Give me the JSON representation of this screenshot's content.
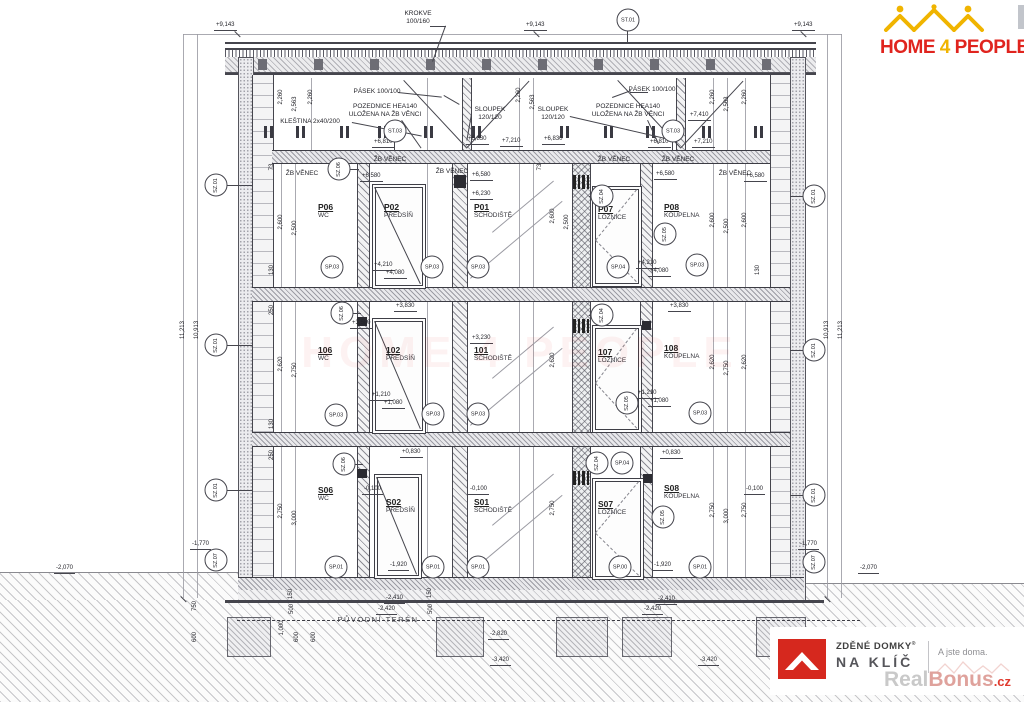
{
  "branding": {
    "header": {
      "word1": "HOME",
      "word2": "4",
      "word3": "PEOPLE"
    },
    "watermark_text": "HOME 4 PEOPLE",
    "footer": {
      "brand_bold": "ZDĚNÉ DOMKY",
      "reg": "®",
      "brand_sub": "NA KLÍČ",
      "tagline": "A jste doma.",
      "wm1": "Real",
      "wm2": "Bonus",
      "wm3": ".cz"
    }
  },
  "colors": {
    "red": "#e0241e",
    "yellow": "#f0b400",
    "line": "#45454d"
  },
  "rooms": [
    {
      "num": "P06",
      "name": "WC",
      "x": 318,
      "y": 203
    },
    {
      "num": "P02",
      "name": "PŘEDSÍŇ",
      "x": 384,
      "y": 203
    },
    {
      "num": "P01",
      "name": "SCHODIŠTĚ",
      "x": 474,
      "y": 203
    },
    {
      "num": "P07",
      "name": "LOŽNICE",
      "x": 598,
      "y": 205
    },
    {
      "num": "P08",
      "name": "KOUPELNA",
      "x": 664,
      "y": 203
    },
    {
      "num": "106",
      "name": "WC",
      "x": 318,
      "y": 346
    },
    {
      "num": "102",
      "name": "PŘEDSÍŇ",
      "x": 386,
      "y": 346
    },
    {
      "num": "101",
      "name": "SCHODIŠTĚ",
      "x": 474,
      "y": 346
    },
    {
      "num": "107",
      "name": "LOŽNICE",
      "x": 598,
      "y": 348
    },
    {
      "num": "108",
      "name": "KOUPELNA",
      "x": 664,
      "y": 344
    },
    {
      "num": "S06",
      "name": "WC",
      "x": 318,
      "y": 486
    },
    {
      "num": "S02",
      "name": "PŘEDSÍŇ",
      "x": 386,
      "y": 498
    },
    {
      "num": "S01",
      "name": "SCHODIŠTĚ",
      "x": 474,
      "y": 498
    },
    {
      "num": "S07",
      "name": "LOŽNICE",
      "x": 598,
      "y": 500
    },
    {
      "num": "S08",
      "name": "KOUPELNA",
      "x": 664,
      "y": 484
    }
  ],
  "elevations": [
    {
      "t": "+9,143",
      "x": 214,
      "y": 22
    },
    {
      "t": "+9,143",
      "x": 524,
      "y": 22
    },
    {
      "t": "+9,143",
      "x": 792,
      "y": 22
    },
    {
      "t": "+7,410",
      "x": 688,
      "y": 112
    },
    {
      "t": "+6,810",
      "x": 372,
      "y": 139
    },
    {
      "t": "+6,830",
      "x": 466,
      "y": 136
    },
    {
      "t": "+7,210",
      "x": 500,
      "y": 138
    },
    {
      "t": "+6,830",
      "x": 542,
      "y": 136
    },
    {
      "t": "+6,810",
      "x": 648,
      "y": 139
    },
    {
      "t": "+7,210",
      "x": 692,
      "y": 139
    },
    {
      "t": "+6,580",
      "x": 360,
      "y": 173
    },
    {
      "t": "+6,580",
      "x": 470,
      "y": 172
    },
    {
      "t": "+6,580",
      "x": 654,
      "y": 171
    },
    {
      "t": "+6,580",
      "x": 744,
      "y": 173
    },
    {
      "t": "+6,230",
      "x": 470,
      "y": 191
    },
    {
      "t": "+4,210",
      "x": 372,
      "y": 262
    },
    {
      "t": "+4,080",
      "x": 384,
      "y": 270
    },
    {
      "t": "+4,210",
      "x": 636,
      "y": 260
    },
    {
      "t": "+4,080",
      "x": 648,
      "y": 268
    },
    {
      "t": "+3,830",
      "x": 394,
      "y": 303
    },
    {
      "t": "+3,830",
      "x": 668,
      "y": 303
    },
    {
      "t": "+3,580",
      "x": 350,
      "y": 320
    },
    {
      "t": "+3,230",
      "x": 470,
      "y": 335
    },
    {
      "t": "+1,210",
      "x": 370,
      "y": 392
    },
    {
      "t": "+1,080",
      "x": 382,
      "y": 400
    },
    {
      "t": "+1,210",
      "x": 636,
      "y": 390
    },
    {
      "t": "+1,080",
      "x": 648,
      "y": 398
    },
    {
      "t": "+0,830",
      "x": 400,
      "y": 449
    },
    {
      "t": "+0,830",
      "x": 660,
      "y": 450
    },
    {
      "t": "-0,100",
      "x": 362,
      "y": 486
    },
    {
      "t": "-0,100",
      "x": 468,
      "y": 486
    },
    {
      "t": "-0,100",
      "x": 744,
      "y": 486
    },
    {
      "t": "-1,920",
      "x": 388,
      "y": 562
    },
    {
      "t": "-1,920",
      "x": 652,
      "y": 562
    },
    {
      "t": "-1,770",
      "x": 190,
      "y": 541
    },
    {
      "t": "-1,770",
      "x": 798,
      "y": 541
    },
    {
      "t": "-2,070",
      "x": 54,
      "y": 565
    },
    {
      "t": "-2,070",
      "x": 858,
      "y": 565
    },
    {
      "t": "-2,410",
      "x": 384,
      "y": 595
    },
    {
      "t": "-2,420",
      "x": 376,
      "y": 606
    },
    {
      "t": "-2,410",
      "x": 656,
      "y": 596
    },
    {
      "t": "-2,420",
      "x": 642,
      "y": 606
    },
    {
      "t": "-2,820",
      "x": 488,
      "y": 631
    },
    {
      "t": "-3,420",
      "x": 490,
      "y": 657
    },
    {
      "t": "-3,420",
      "x": 698,
      "y": 657
    }
  ],
  "vdims": [
    {
      "t": "2,260",
      "x": 281,
      "y": 97
    },
    {
      "t": "2,563",
      "x": 295,
      "y": 104
    },
    {
      "t": "2,260",
      "x": 311,
      "y": 97
    },
    {
      "t": "2,260",
      "x": 519,
      "y": 95
    },
    {
      "t": "2,563",
      "x": 533,
      "y": 102
    },
    {
      "t": "2,260",
      "x": 713,
      "y": 97
    },
    {
      "t": "2,563",
      "x": 727,
      "y": 104
    },
    {
      "t": "2,260",
      "x": 745,
      "y": 97
    },
    {
      "t": "2,600",
      "x": 281,
      "y": 222
    },
    {
      "t": "2,500",
      "x": 295,
      "y": 228
    },
    {
      "t": "2,600",
      "x": 553,
      "y": 216
    },
    {
      "t": "2,500",
      "x": 567,
      "y": 222
    },
    {
      "t": "2,600",
      "x": 713,
      "y": 220
    },
    {
      "t": "2,500",
      "x": 727,
      "y": 226
    },
    {
      "t": "2,600",
      "x": 745,
      "y": 220
    },
    {
      "t": "2,620",
      "x": 281,
      "y": 364
    },
    {
      "t": "2,750",
      "x": 295,
      "y": 370
    },
    {
      "t": "2,620",
      "x": 553,
      "y": 360
    },
    {
      "t": "2,620",
      "x": 713,
      "y": 362
    },
    {
      "t": "2,750",
      "x": 727,
      "y": 368
    },
    {
      "t": "2,620",
      "x": 745,
      "y": 362
    },
    {
      "t": "2,750",
      "x": 281,
      "y": 511
    },
    {
      "t": "3,000",
      "x": 295,
      "y": 518
    },
    {
      "t": "2,750",
      "x": 553,
      "y": 508
    },
    {
      "t": "2,750",
      "x": 713,
      "y": 510
    },
    {
      "t": "3,000",
      "x": 727,
      "y": 516
    },
    {
      "t": "2,750",
      "x": 745,
      "y": 510
    },
    {
      "t": "11,213",
      "x": 183,
      "y": 330
    },
    {
      "t": "10,913",
      "x": 197,
      "y": 330
    },
    {
      "t": "10,913",
      "x": 827,
      "y": 330
    },
    {
      "t": "11,213",
      "x": 841,
      "y": 330
    },
    {
      "t": "73",
      "x": 272,
      "y": 167
    },
    {
      "t": "130",
      "x": 272,
      "y": 270
    },
    {
      "t": "250",
      "x": 272,
      "y": 310
    },
    {
      "t": "130",
      "x": 272,
      "y": 424
    },
    {
      "t": "250",
      "x": 272,
      "y": 455
    },
    {
      "t": "73",
      "x": 540,
      "y": 167
    },
    {
      "t": "130",
      "x": 758,
      "y": 270
    },
    {
      "t": "750",
      "x": 195,
      "y": 606
    },
    {
      "t": "600",
      "x": 195,
      "y": 637
    },
    {
      "t": "1,000",
      "x": 282,
      "y": 628
    },
    {
      "t": "600",
      "x": 297,
      "y": 637
    },
    {
      "t": "600",
      "x": 314,
      "y": 637
    },
    {
      "t": "150",
      "x": 291,
      "y": 594
    },
    {
      "t": "500",
      "x": 292,
      "y": 609
    },
    {
      "t": "150",
      "x": 430,
      "y": 593
    },
    {
      "t": "500",
      "x": 431,
      "y": 609
    }
  ],
  "bubbles": [
    {
      "t": "ST.01",
      "x": 628,
      "y": 20,
      "r": 0
    },
    {
      "t": "ST.03",
      "x": 395,
      "y": 131,
      "r": 0
    },
    {
      "t": "ST.03",
      "x": 673,
      "y": 131,
      "r": 0
    },
    {
      "t": "SZ.01",
      "x": 216,
      "y": 185,
      "r": 1
    },
    {
      "t": "SZ.01",
      "x": 216,
      "y": 345,
      "r": 1
    },
    {
      "t": "SZ.01",
      "x": 216,
      "y": 490,
      "r": 1
    },
    {
      "t": "SZ.07",
      "x": 216,
      "y": 560,
      "r": 1
    },
    {
      "t": "SZ.01",
      "x": 814,
      "y": 196,
      "r": 1
    },
    {
      "t": "SZ.01",
      "x": 814,
      "y": 350,
      "r": 1
    },
    {
      "t": "SZ.01",
      "x": 814,
      "y": 495,
      "r": 1
    },
    {
      "t": "SZ.07",
      "x": 814,
      "y": 562,
      "r": 1
    },
    {
      "t": "SZ.06",
      "x": 339,
      "y": 169,
      "r": 1
    },
    {
      "t": "SZ.06",
      "x": 342,
      "y": 313,
      "r": 1
    },
    {
      "t": "SZ.06",
      "x": 344,
      "y": 464,
      "r": 1
    },
    {
      "t": "SZ.04",
      "x": 602,
      "y": 196,
      "r": 1
    },
    {
      "t": "SZ.04",
      "x": 602,
      "y": 315,
      "r": 1
    },
    {
      "t": "SZ.04",
      "x": 597,
      "y": 463,
      "r": 1
    },
    {
      "t": "SP.04",
      "x": 622,
      "y": 463,
      "r": 0
    },
    {
      "t": "SZ.05",
      "x": 665,
      "y": 234,
      "r": 1
    },
    {
      "t": "SZ.05",
      "x": 627,
      "y": 403,
      "r": 1
    },
    {
      "t": "SZ.05",
      "x": 663,
      "y": 517,
      "r": 1
    },
    {
      "t": "SP.03",
      "x": 332,
      "y": 267,
      "r": 0
    },
    {
      "t": "SP.03",
      "x": 432,
      "y": 267,
      "r": 0
    },
    {
      "t": "SP.03",
      "x": 478,
      "y": 267,
      "r": 0
    },
    {
      "t": "SP.04",
      "x": 618,
      "y": 267,
      "r": 0
    },
    {
      "t": "SP.03",
      "x": 697,
      "y": 265,
      "r": 0
    },
    {
      "t": "SP.03",
      "x": 336,
      "y": 415,
      "r": 0
    },
    {
      "t": "SP.03",
      "x": 433,
      "y": 414,
      "r": 0
    },
    {
      "t": "SP.03",
      "x": 478,
      "y": 414,
      "r": 0
    },
    {
      "t": "SP.03",
      "x": 700,
      "y": 413,
      "r": 0
    },
    {
      "t": "SP.01",
      "x": 336,
      "y": 567,
      "r": 0
    },
    {
      "t": "SP.01",
      "x": 433,
      "y": 567,
      "r": 0
    },
    {
      "t": "SP.01",
      "x": 478,
      "y": 567,
      "r": 0
    },
    {
      "t": "SP.00",
      "x": 620,
      "y": 567,
      "r": 0
    },
    {
      "t": "SP.01",
      "x": 700,
      "y": 567,
      "r": 0
    }
  ],
  "labels": [
    {
      "ls": [
        "KROKVE",
        "100/160"
      ],
      "x": 418,
      "y": 10
    },
    {
      "ls": [
        "PÁSEK 100/100"
      ],
      "x": 377,
      "y": 88
    },
    {
      "ls": [
        "PÁSEK 100/100"
      ],
      "x": 652,
      "y": 86
    },
    {
      "ls": [
        "POZEDNICE HEA140",
        "ULOŽENA NA ŽB VĚNCI"
      ],
      "x": 385,
      "y": 103
    },
    {
      "ls": [
        "POZEDNICE HEA140",
        "ULOŽENA NA ŽB VĚNCI"
      ],
      "x": 628,
      "y": 103
    },
    {
      "ls": [
        "SLOUPEK",
        "120/120"
      ],
      "x": 490,
      "y": 106
    },
    {
      "ls": [
        "SLOUPEK",
        "120/120"
      ],
      "x": 553,
      "y": 106
    },
    {
      "ls": [
        "KLEŠTINA 2x40/200"
      ],
      "x": 310,
      "y": 118
    },
    {
      "ls": [
        "ŽB VĚNEC"
      ],
      "x": 302,
      "y": 170
    },
    {
      "ls": [
        "ŽB VĚNEC"
      ],
      "x": 390,
      "y": 156
    },
    {
      "ls": [
        "ŽB VĚNEC"
      ],
      "x": 452,
      "y": 168
    },
    {
      "ls": [
        "ŽB VĚNEC"
      ],
      "x": 614,
      "y": 156
    },
    {
      "ls": [
        "ŽB VĚNEC"
      ],
      "x": 678,
      "y": 156
    },
    {
      "ls": [
        "ŽB VĚNEC"
      ],
      "x": 735,
      "y": 170
    },
    {
      "ls": [
        "PŮVODNÍ TERÉN"
      ],
      "x": 378,
      "y": 616,
      "cls": "terlbl"
    }
  ]
}
